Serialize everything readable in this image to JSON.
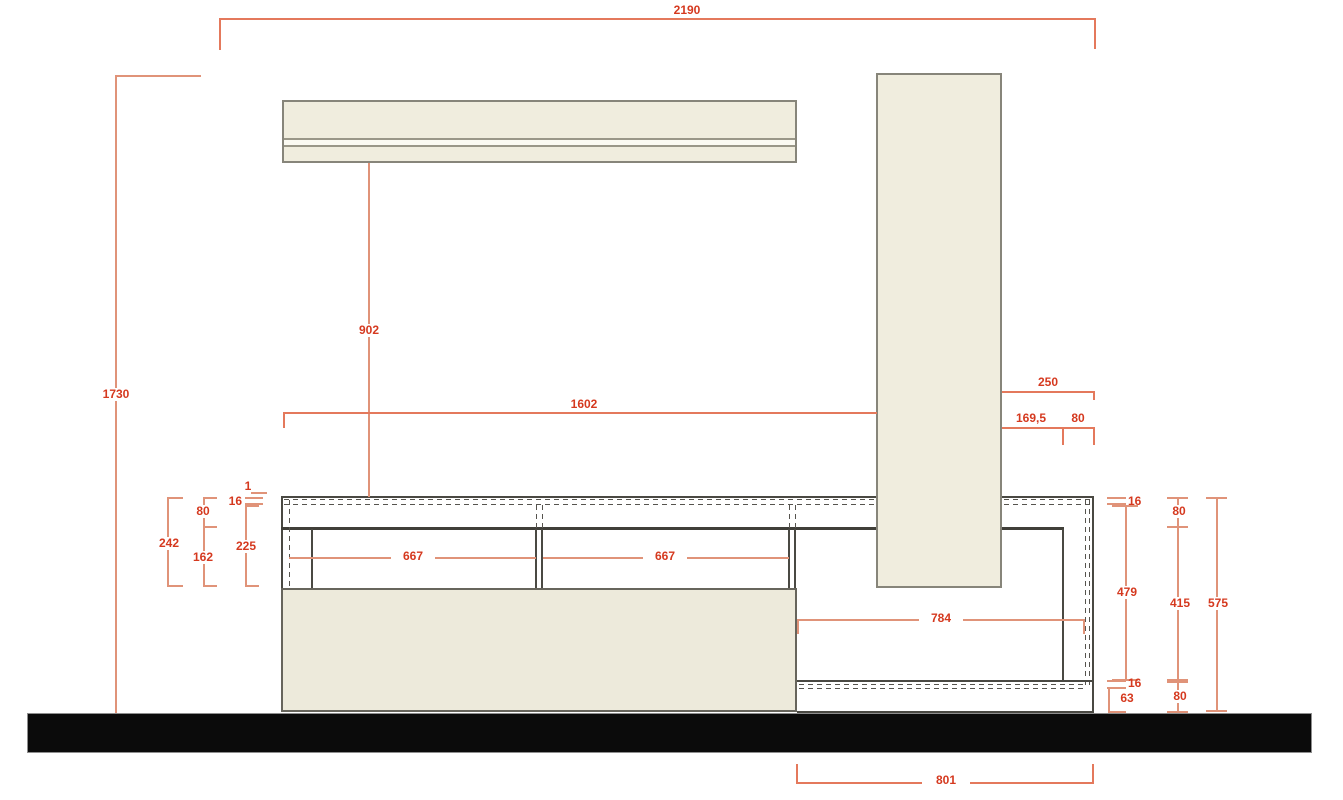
{
  "drawing": {
    "kind": "furniture wall-unit elevation, technical CAD drawing with dimensions in mm"
  },
  "dims": {
    "total_width": "2190",
    "height_left": "1730",
    "shelf_drop": "902",
    "span_left": "1602",
    "span_right": "250",
    "offset_169": "169,5",
    "offset_80": "80",
    "left_242": "242",
    "left_80": "80",
    "left_162": "162",
    "left_16": "16",
    "left_1": "1",
    "left_225": "225",
    "bay_a": "667",
    "bay_b": "667",
    "right_16_top": "16",
    "right_80_top": "80",
    "niche_width": "784",
    "right_479": "479",
    "right_415": "415",
    "right_575": "575",
    "right_16_bottom": "16",
    "right_63": "63",
    "right_80_bottom": "80",
    "plinth_width": "801"
  },
  "colors": {
    "dimension_text": "#d5391f",
    "dimension_line": "#e09379",
    "dimension_line_strong": "#e4795c",
    "carcass_line": "#4a4943",
    "hidden_line": "#56544e",
    "panel_fill": "#f0edde",
    "panel_border": "#87857a",
    "door_fill": "#edeadb",
    "door_border": "#67655c",
    "floor_fill": "#0b0b0b",
    "background": "#ffffff"
  }
}
